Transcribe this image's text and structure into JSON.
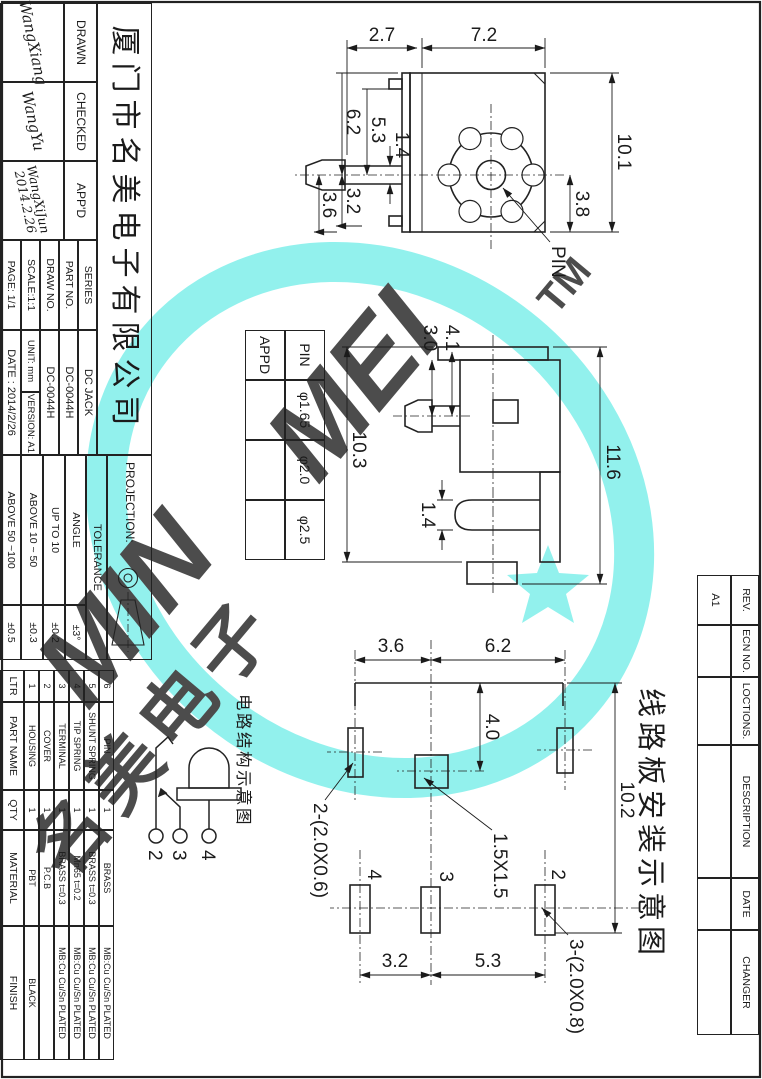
{
  "meta": {
    "accent_cyan": "#74EEE9",
    "line_color": "#222222"
  },
  "title_block": {
    "company": "厦门市名美电子有限公司",
    "drawn_label": "DRAWN",
    "checked_label": "CHECKED",
    "appd_label": "APP'D",
    "drawn_sig": "WangXiang",
    "checked_sig": "WangYu",
    "appd_sig": "WangXiJun",
    "appd_date": "2014.2.26",
    "series_label": "SERIES",
    "series_value": "DC JACK",
    "part_no_label": "PART NO.",
    "part_no_value": "DC-0044H",
    "draw_no_label": "DRAW NO.",
    "draw_no_value": "DC-0044H",
    "scale": "SCALE:1:1",
    "unit": "UNIT: mm",
    "version": "VERSION: A1",
    "page": "PAGE: 1/1",
    "date": "DATE : 2014/2/26",
    "projection_label": "PROJECTION:",
    "tolerance_label": "TOLERANCE",
    "tolerance_rows": [
      {
        "range": "ANGLE",
        "value": "±3°"
      },
      {
        "range": "UP TO 10",
        "value": "±0.2"
      },
      {
        "range": "ABOVE 10 ~ 50",
        "value": "±0.3"
      },
      {
        "range": "ABOVE 50 ~100",
        "value": "±0.5"
      }
    ]
  },
  "parts_table": {
    "headers": {
      "ltr": "LTR",
      "name": "PART NAME",
      "qty": "QTY",
      "material": "MATERIAL",
      "finish": "FINISH"
    },
    "items": [
      {
        "ltr": "6",
        "name": "PIN",
        "qty": "1",
        "material": "BRASS",
        "finish": "MB:Cu  Cu/Sn  PLATED"
      },
      {
        "ltr": "5",
        "name": "SHUNT SPRING",
        "qty": "1",
        "material": "BRASS  t=0.3",
        "finish": "MB:Cu  Cu/Sn  PLATED"
      },
      {
        "ltr": "4",
        "name": "TIP SPRING",
        "qty": "1",
        "material": "Mn65  t=0.2",
        "finish": "MB:Cu  Cu/Sn  PLATED"
      },
      {
        "ltr": "3",
        "name": "TERMINAL",
        "qty": "1",
        "material": "BRASS  t=0.3",
        "finish": "MB:Cu  Cu/Sn  PLATED"
      },
      {
        "ltr": "2",
        "name": "COVER",
        "qty": "1",
        "material": "P.C.B",
        "finish": ""
      },
      {
        "ltr": "1",
        "name": "HOUSING",
        "qty": "1",
        "material": "PBT",
        "finish": "BLACK"
      }
    ]
  },
  "revision_table": {
    "headers": [
      "REV.",
      "ECN NO.",
      "LOCTIONS.",
      "DESCRIPTION",
      "DATE",
      "CHANGER"
    ],
    "rev_value": "A1"
  },
  "pin_table": {
    "row1_label": "PIN",
    "row2_label": "APPD",
    "values": [
      "φ1.65",
      "φ2.0",
      "φ2.5"
    ]
  },
  "views": {
    "front": {
      "pin_label": "PIN",
      "dims": {
        "w1": "2.7",
        "w2": "7.2",
        "h_all": "10.1",
        "h_c": "3.8",
        "b1": "6.2",
        "b2": "5.3",
        "b3": "1.4",
        "b4": "3.2",
        "b5": "3.6"
      }
    },
    "side": {
      "dims": {
        "total": "11.6",
        "body": "10.3",
        "p1": "3.0",
        "p2": "4.1",
        "tab": "1.4"
      }
    },
    "pcb": {
      "title": "线路板安装示意图",
      "dims": {
        "v1": "3.6",
        "v2": "6.2",
        "h1": "4.0",
        "total": "10.2",
        "b1": "3.2",
        "b2": "5.3"
      },
      "hole_center": "1.5X1.5",
      "slot_a": "2-(2.0X0.6)",
      "slot_b": "3-(2.0X0.8)",
      "pads": [
        "2",
        "3",
        "4"
      ]
    }
  },
  "circuit": {
    "title": "电路结构示意图",
    "terminals": [
      "2",
      "3",
      "4"
    ]
  },
  "watermark": {
    "part1": "MIN",
    "part2": "MEI",
    "tm": "TM",
    "cn": "名美电子"
  }
}
